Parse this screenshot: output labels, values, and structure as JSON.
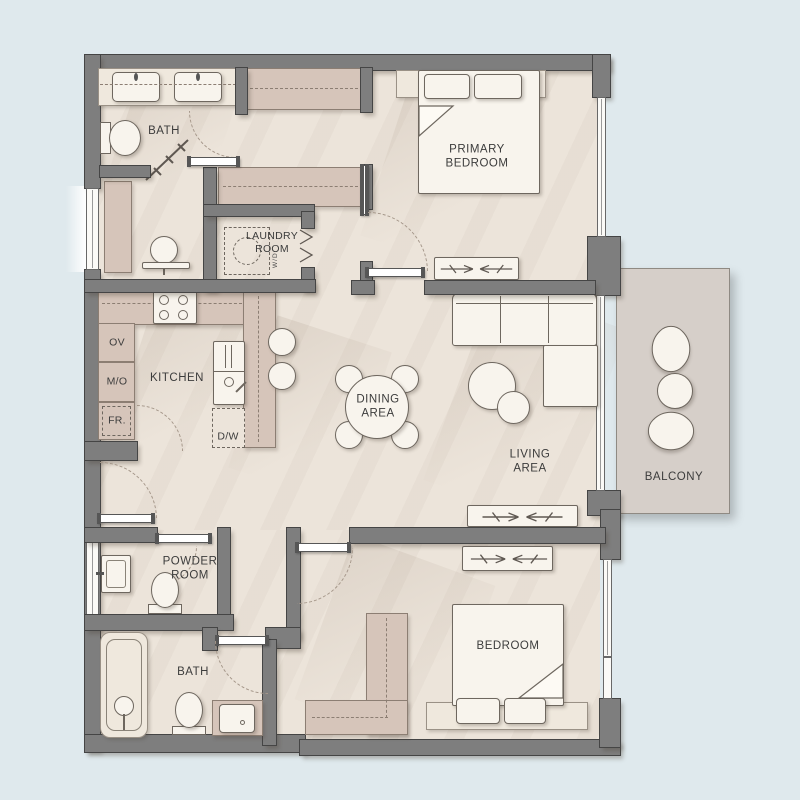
{
  "rooms": {
    "bath_top": "BATH",
    "laundry": [
      "LAUNDRY",
      "ROOM"
    ],
    "primary_bedroom": [
      "PRIMARY",
      "BEDROOM"
    ],
    "kitchen": "KITCHEN",
    "dining": [
      "DINING",
      "AREA"
    ],
    "living": [
      "LIVING",
      "AREA"
    ],
    "balcony": "BALCONY",
    "powder": [
      "POWDER",
      "ROOM"
    ],
    "bath_bottom": "BATH",
    "bedroom": "BEDROOM"
  },
  "appliances": {
    "oven": "OV",
    "microwave": "M/O",
    "fridge": "FR.",
    "dishwasher": "D/W",
    "washer_dryer": "W/D"
  },
  "colors": {
    "background": "#dfe9ed",
    "floor": "#ece4da",
    "wall": "#7e7e7e",
    "wall_outline": "#454545",
    "cabinet": "#d6c5ba",
    "furniture": "#f8f4ed",
    "balcony_floor": "#d6cfc9",
    "text": "#3c3c3c",
    "dash": "#a5978a"
  }
}
